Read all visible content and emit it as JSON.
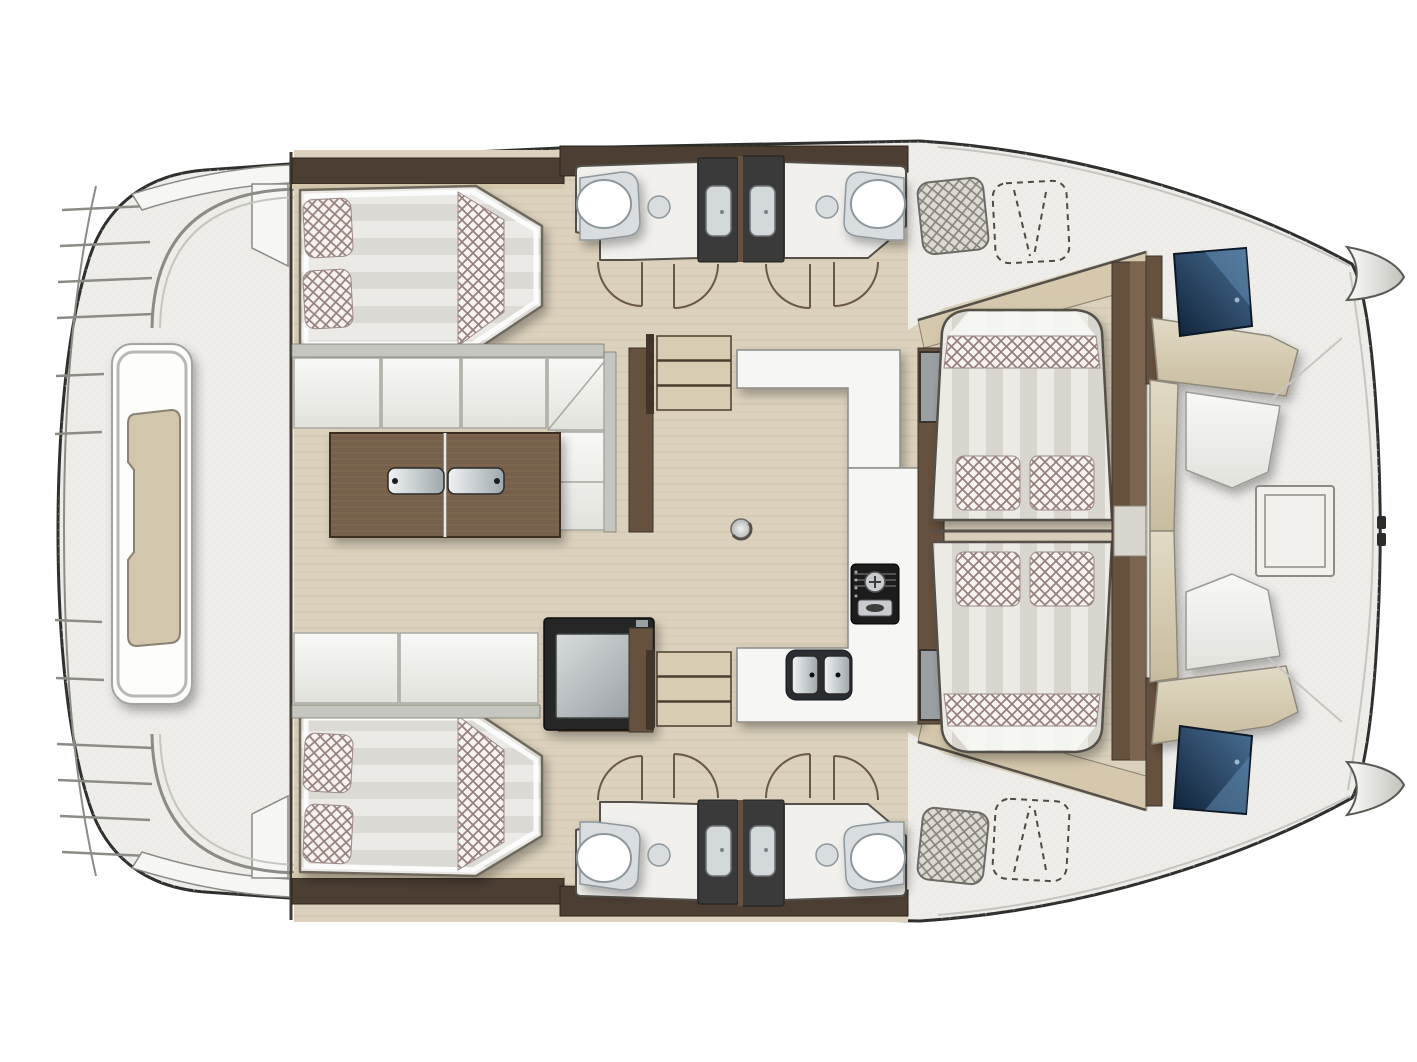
{
  "colors": {
    "deck": "#efedea",
    "speck": "#dcd9d5",
    "outline": "#2f2f2d",
    "line_soft": "#8c8c86",
    "line_light": "#c6c6c1",
    "line_dark": "#55504a",
    "wood_floor": "#dbd1bc",
    "wood_grain": "#cfc4ac",
    "wood_edge": "#8a8274",
    "wall_dark": "#4c3e33",
    "wall_brown": "#66513f",
    "wall_brown_light": "#7b6551",
    "shelf_tan": "#d5c8ac",
    "bench_tan": "#d2c7ad",
    "stair_tread": "#d8ccb2",
    "stair_rail": "#43352a",
    "table_base": "#76604b",
    "table_grain": "#8b745c",
    "table_edge": "#3c2f24",
    "sofa_back": "#c6c6c1",
    "sofa_edge": "#a9a9a3",
    "stripe_a": "#eceae5",
    "stripe_b": "#d8d6cf",
    "bed_a": "#eceae6",
    "bed_b": "#dcdad4",
    "check_bg": "#f7f3f0",
    "check_line": "#96807d",
    "checkgray_bg": "#ddd9d3",
    "checkgray_line": "#87837c",
    "bath_floor": "#f1f0ed",
    "fixture_mid": "#d9dde0",
    "fixture_rim": "#8d979c",
    "shower_dark": "#3a3a3a",
    "shower_panel": "#d3d8da",
    "stove_black": "#1b1b1b",
    "sink_dark": "#2b2f33",
    "white_trim": "#f6f6f4",
    "arc_stroke": "#6b5848",
    "dash_stroke": "#4f4a44"
  }
}
